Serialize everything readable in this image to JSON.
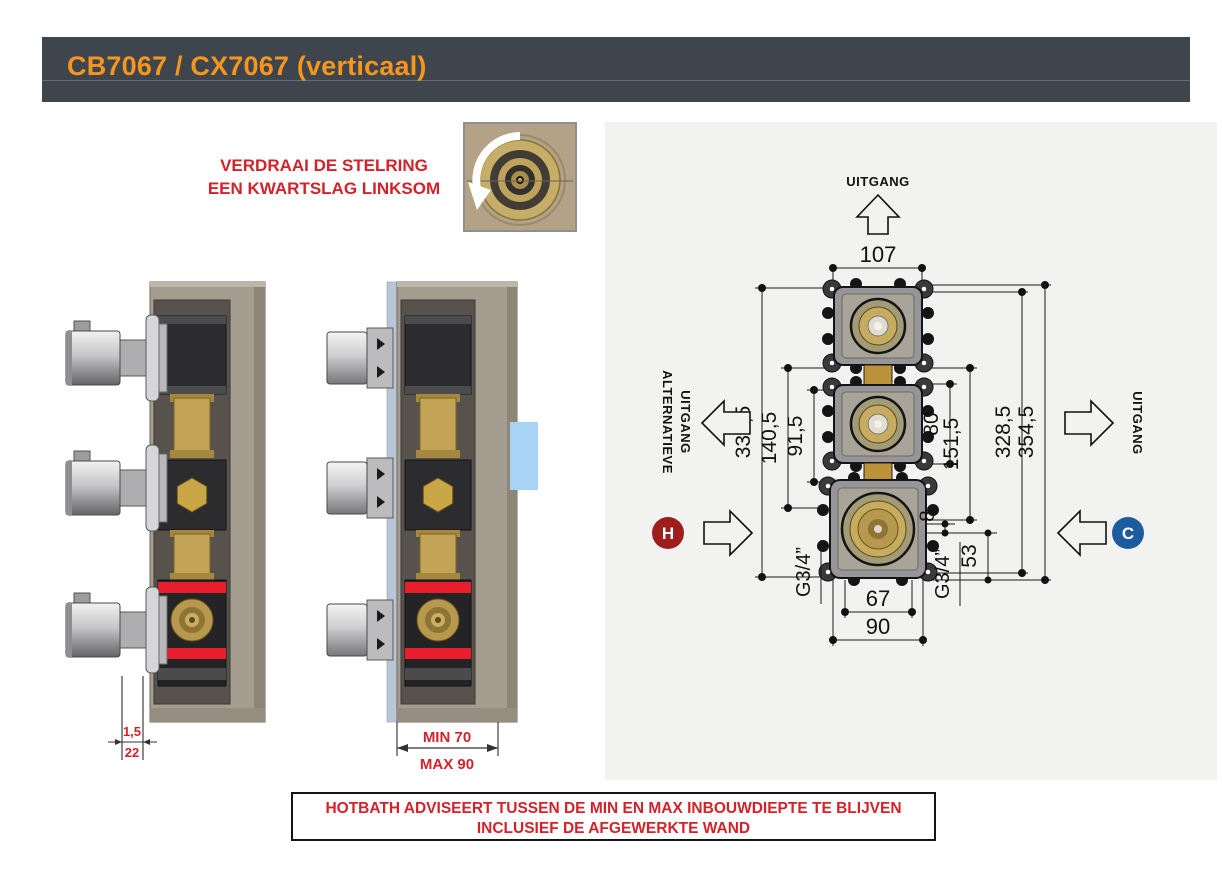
{
  "header": {
    "title": "CB7067 / CX7067 (verticaal)",
    "bg_color": "#3e454c",
    "accent_color": "#f6961e"
  },
  "instruction": {
    "line1": "VERDRAAI DE STELRING",
    "line2": "EEN KWARTSLAG LINKSOM",
    "color": "#d2232a"
  },
  "wall_dims": {
    "finish": "1,5",
    "wall": "22"
  },
  "depth_dims": {
    "min": "MIN 70",
    "max": "MAX 90"
  },
  "drawing": {
    "outlet_top": "UITGANG",
    "outlet_alt_line1": "ALTERNATIEVE",
    "outlet_alt_line2": "UITGANG",
    "outlet_right": "UITGANG",
    "hot_label": "H",
    "cold_label": "C",
    "hot_color": "#9e1e1e",
    "cold_color": "#1d5b9f",
    "dims": {
      "width_ports": "107",
      "height_total_left": "339,5",
      "height_mid_left": "140,5",
      "height_inner_left": "91,5",
      "height_inner_right": "80",
      "height_mid_right": "151,5",
      "height_right_inner": "328,5",
      "height_right_outer": "354,5",
      "offset_top": "8",
      "offset_bottom": "53",
      "width_inner": "67",
      "width_outer": "90",
      "thread_left": "G3/4”",
      "thread_right": "G3/4”"
    }
  },
  "notice": {
    "line1": "HOTBATH ADVISEERT TUSSEN DE MIN EN MAX INBOUWDIEPTE TE BLIJVEN",
    "line2": "INCLUSIEF DE AFGEWERKTE WAND"
  }
}
